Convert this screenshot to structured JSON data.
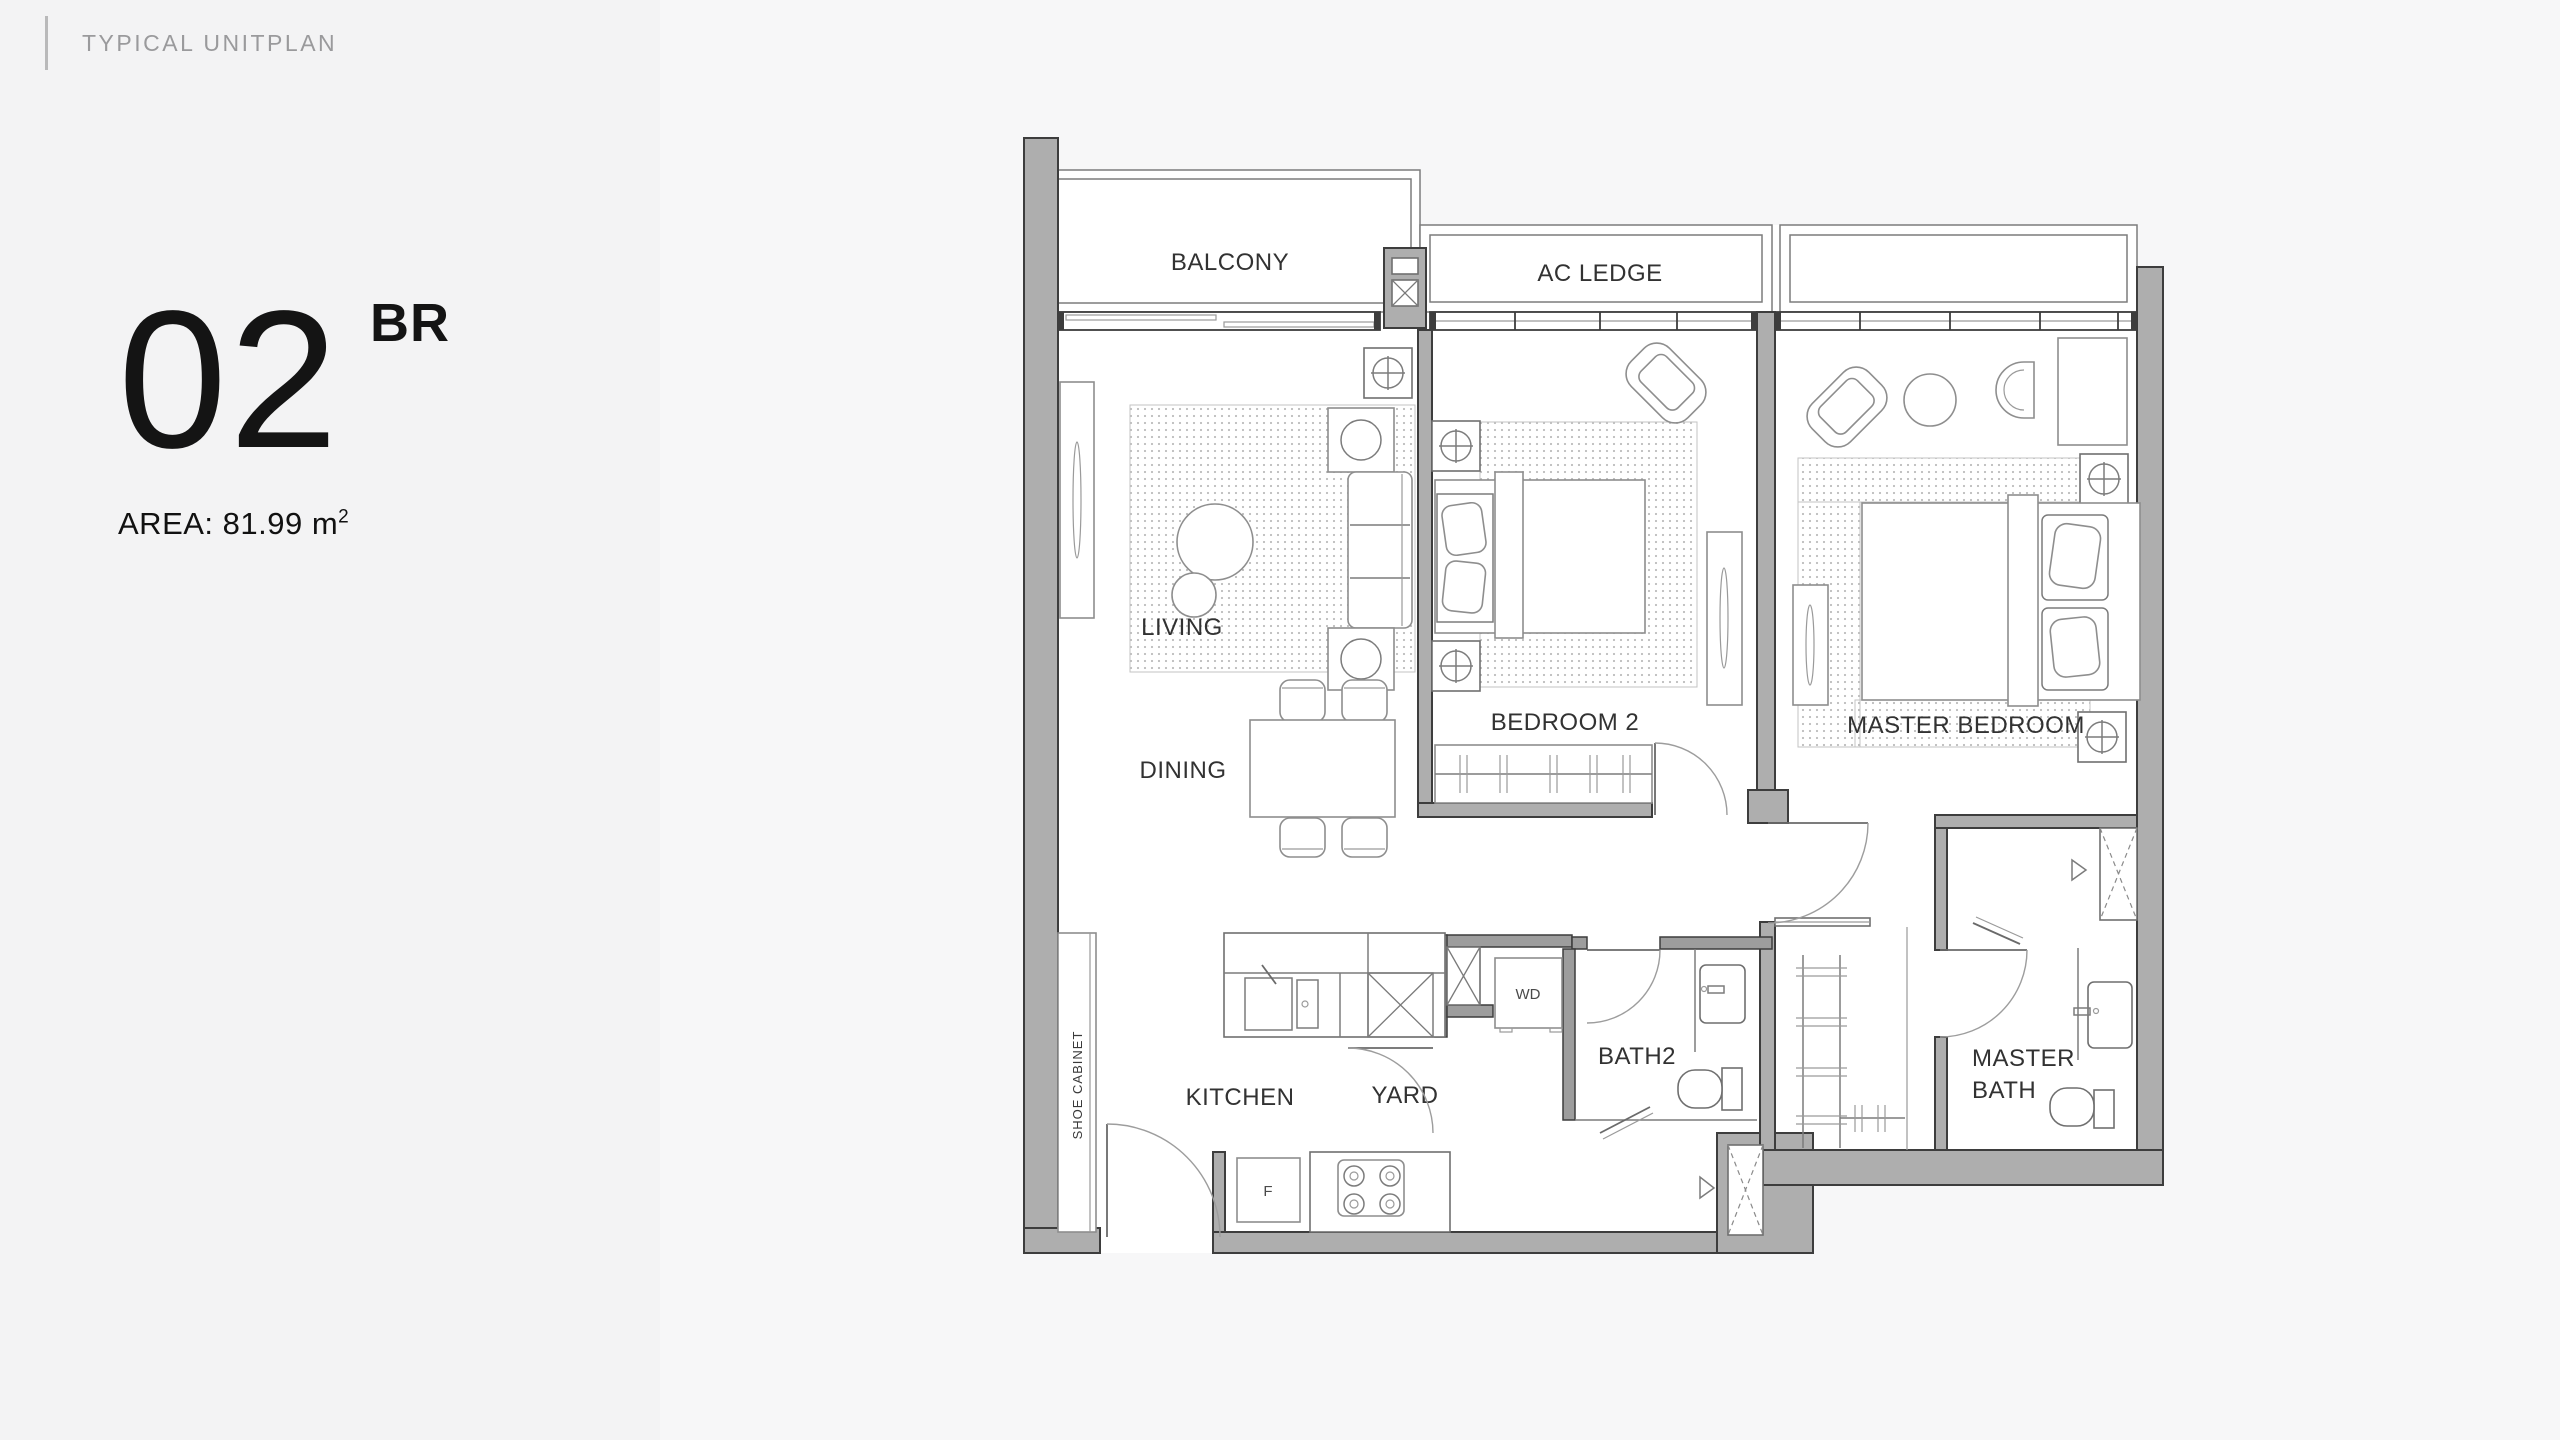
{
  "header": {
    "title": "TYPICAL UNITPLAN"
  },
  "unit": {
    "number": "02",
    "type": "BR",
    "area_label": "AREA: 81.99 m",
    "area_superscript": "2"
  },
  "plan": {
    "labels": {
      "balcony": "BALCONY",
      "ac_ledge": "AC LEDGE",
      "living": "LIVING",
      "dining": "DINING",
      "bedroom2": "BEDROOM 2",
      "master_bedroom": "MASTER BEDROOM",
      "kitchen": "KITCHEN",
      "yard": "YARD",
      "bath2": "BATH2",
      "master_bath_line1": "MASTER",
      "master_bath_line2": "BATH",
      "shoe_cabinet": "SHOE CABINET",
      "washer_dryer": "WD",
      "fridge": "F"
    },
    "colors": {
      "wall_fill": "#aeaeae",
      "wall_line": "#3d3d3d",
      "floor": "#ffffff",
      "background": "#f7f7f8",
      "label_text": "#323232",
      "kicker_text": "#9a9a9c"
    }
  }
}
